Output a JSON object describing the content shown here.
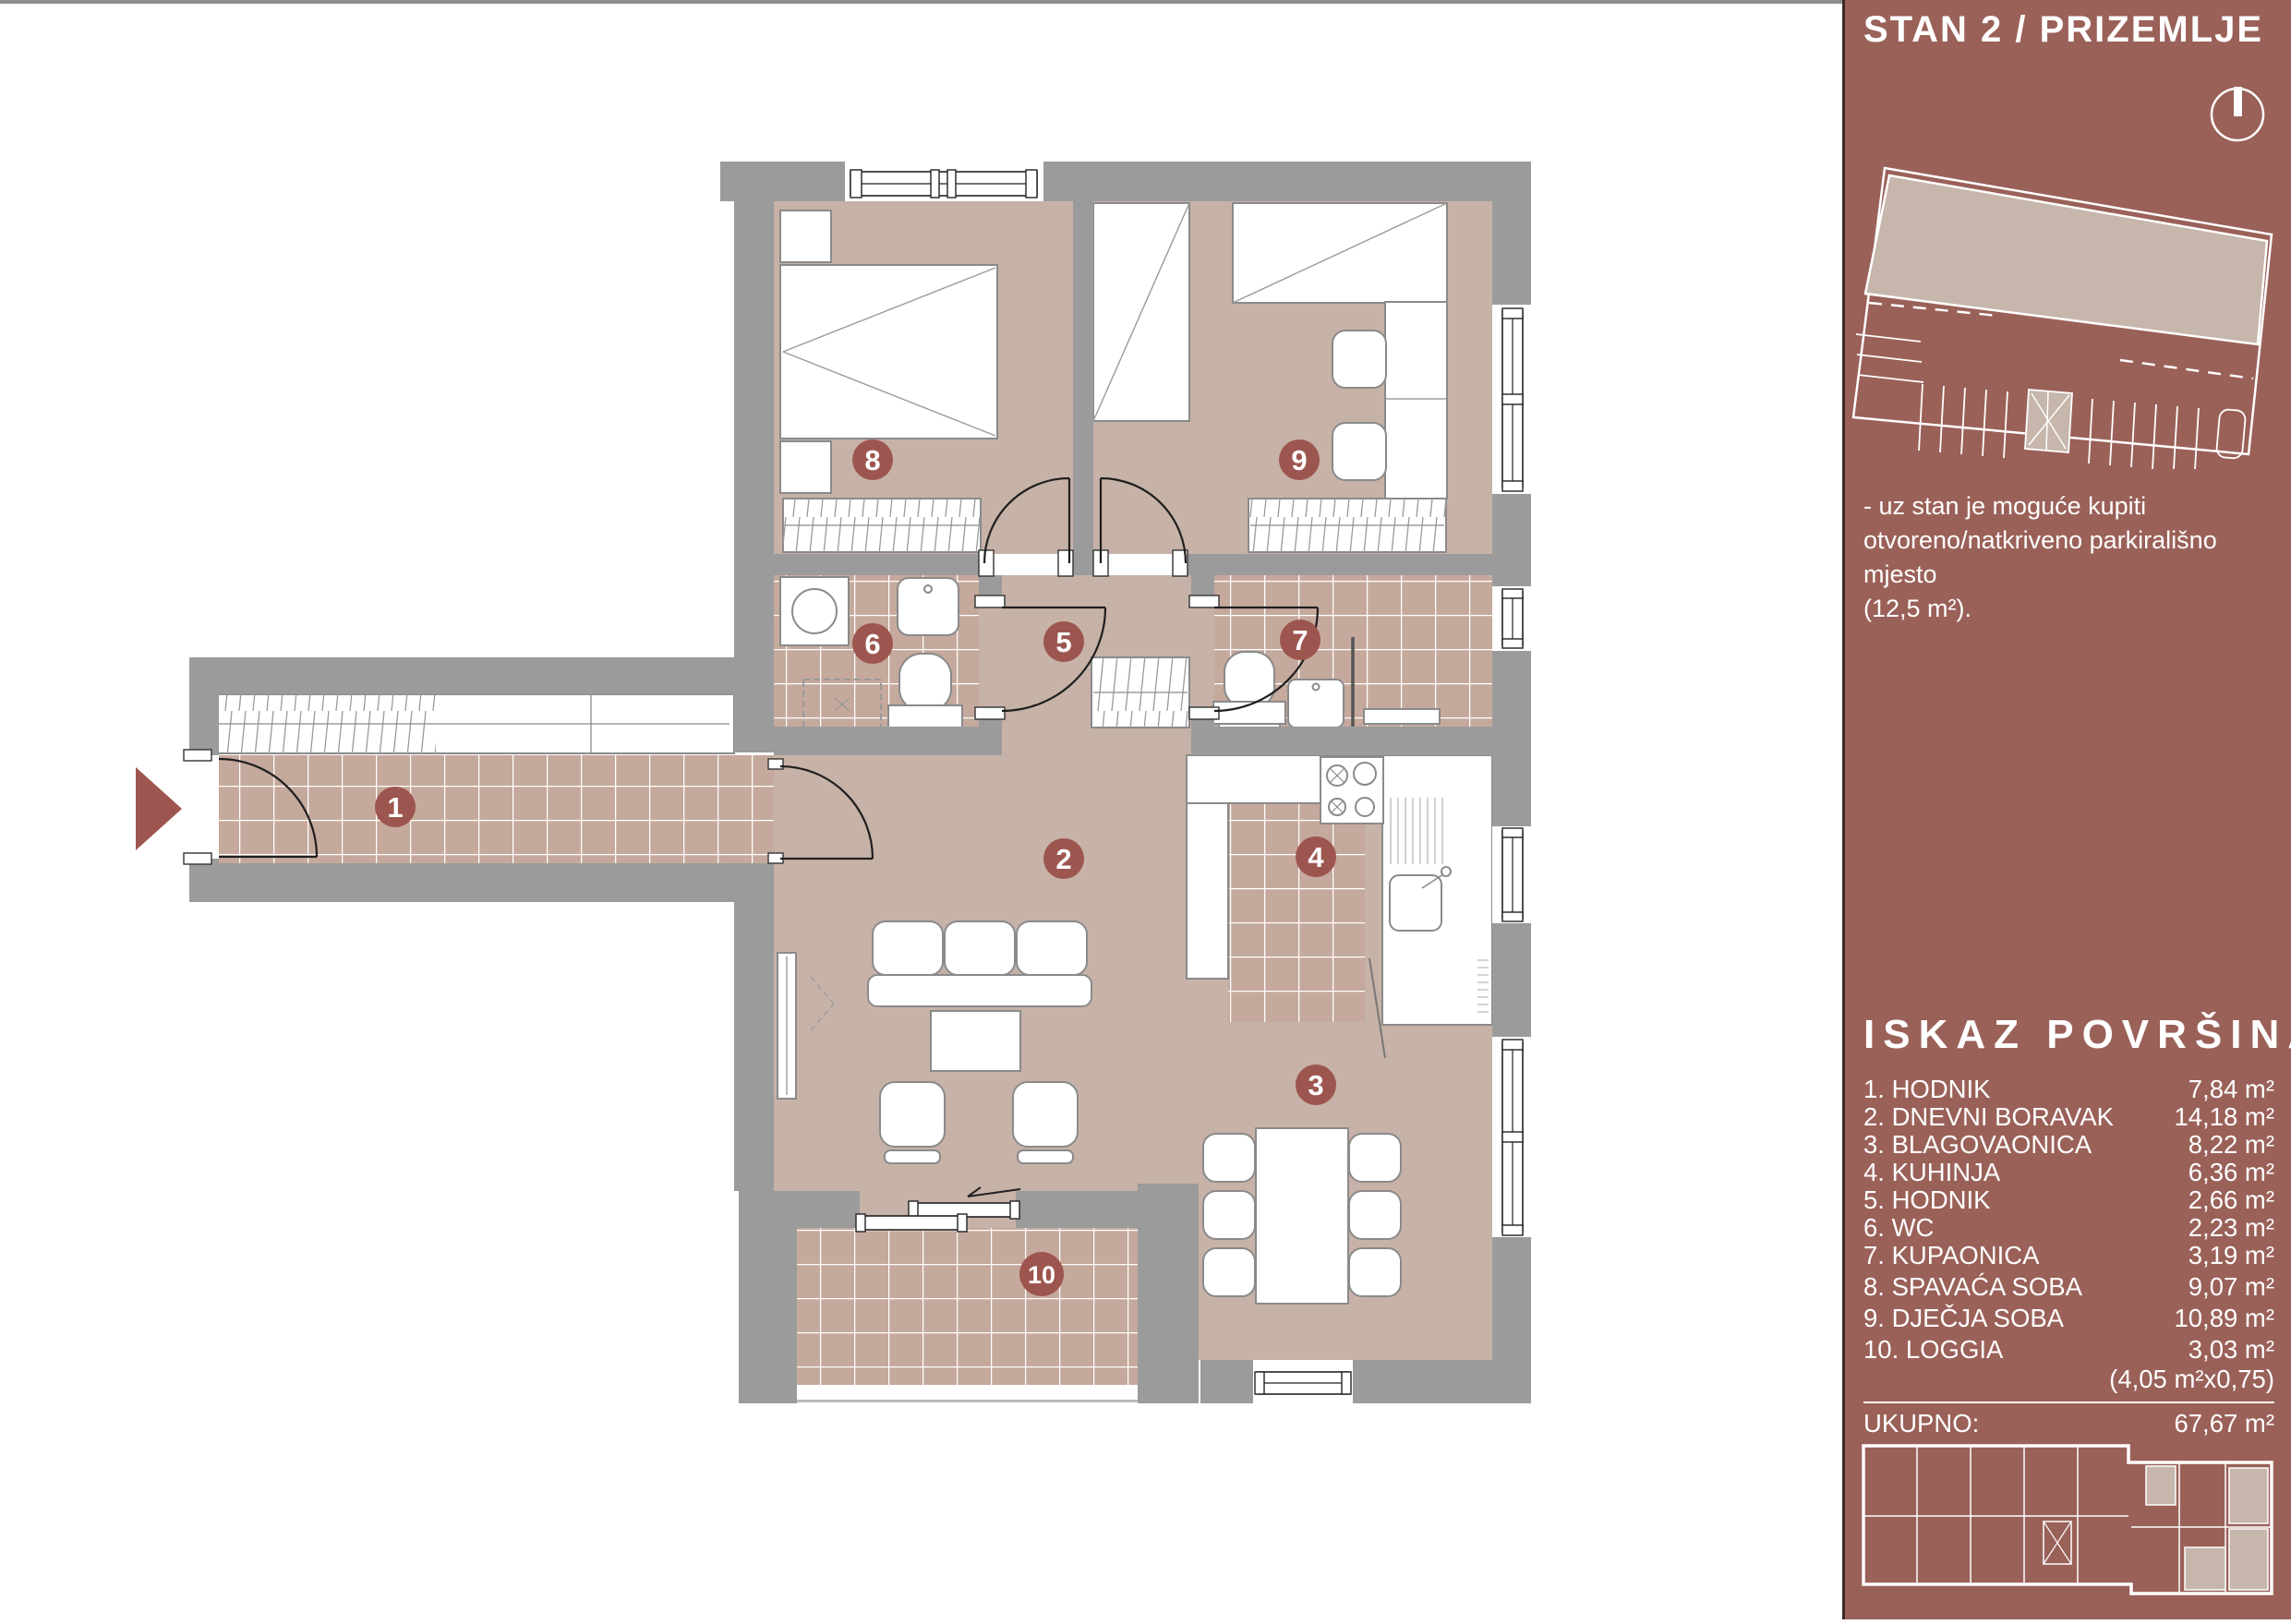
{
  "sidebar": {
    "title": "STAN 2 / PRIZEMLJE",
    "note": [
      "- uz stan je moguće kupiti",
      "otvoreno/natkriveno parkirališno mjesto",
      "(12,5 m²)."
    ],
    "areas_heading": "ISKAZ POVRŠINA:",
    "rooms": [
      {
        "label": "1. HODNIK",
        "area": "7,84 m²"
      },
      {
        "label": "2. DNEVNI BORAVAK",
        "area": "14,18 m²"
      },
      {
        "label": "3. BLAGOVAONICA",
        "area": "8,22 m²"
      },
      {
        "label": "4. KUHINJA",
        "area": "6,36 m²"
      },
      {
        "label": "5. HODNIK",
        "area": "2,66 m²"
      },
      {
        "label": "6. WC",
        "area": "2,23 m²"
      },
      {
        "label": "7. KUPAONICA",
        "area": "3,19 m²"
      },
      {
        "label": "8. SPAVAĆA SOBA",
        "area": "9,07 m²"
      },
      {
        "label": "9. DJEČJA SOBA",
        "area": "10,89 m²"
      },
      {
        "label": "10. LOGGIA",
        "area": "3,03 m²"
      }
    ],
    "loggia_factor_note": "(4,05 m²x0,75)",
    "total_label": "UKUPNO:",
    "total_value": "67,67 m²"
  },
  "plan": {
    "badges": [
      "1",
      "2",
      "3",
      "4",
      "5",
      "6",
      "7",
      "8",
      "9",
      "10"
    ]
  },
  "colors": {
    "sidebar_bg": "#9a6159",
    "wall_gray": "#9b9b9b",
    "floor_beige": "#c7b2a7",
    "tile_beige": "#c5a99c",
    "badge_maroon": "#9d564f",
    "entry_arrow": "#9d564f",
    "mini_plan_fill": "#c6b6ab"
  }
}
